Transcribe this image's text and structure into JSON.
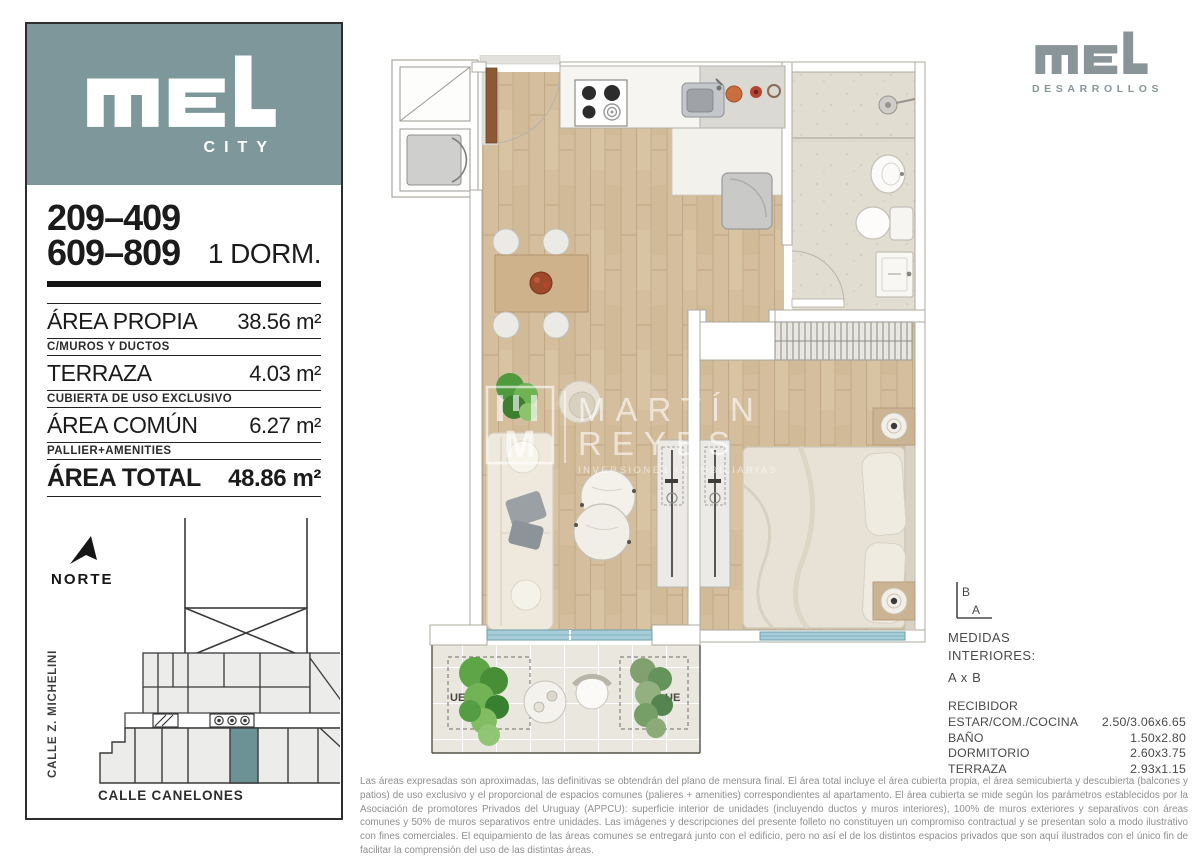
{
  "brand": {
    "city_label": "CITY",
    "desarrollos_label": "DESARROLLOS",
    "teal_color": "#7d979b",
    "logo_gray_color": "#8a9599"
  },
  "sidebar": {
    "unit_range_1": "209–409",
    "unit_range_2": "609–809",
    "unit_type": "1 DORM.",
    "rows": [
      {
        "label": "ÁREA PROPIA",
        "value": "38.56 m²"
      },
      {
        "label": "TERRAZA",
        "value": "4.03 m²"
      },
      {
        "label": "ÁREA COMÚN",
        "value": "6.27 m²"
      },
      {
        "label": "ÁREA TOTAL",
        "value": "48.86 m²"
      }
    ],
    "notes": [
      "C/MUROS Y DUCTOS",
      "CUBIERTA DE USO EXCLUSIVO",
      "PALLIER+AMENITIES"
    ],
    "north_label": "NORTE",
    "map": {
      "street_left": "CALLE Z. MICHELINI",
      "street_bottom": "CALLE CANELONES",
      "unit_highlight_color": "#6d9296"
    }
  },
  "plan": {
    "watermark": {
      "initial": "M",
      "name_line1": "MARTÍN",
      "name_line2": "REYES",
      "tagline": "INVERSIONES INMOBILIARIAS"
    },
    "exterior_unit_label": "UE"
  },
  "measures": {
    "axis": {
      "vertical": "B",
      "horizontal": "A"
    },
    "heading1": "MEDIDAS",
    "heading2": "INTERIORES:",
    "heading3": "A x B",
    "rows": [
      {
        "label": "RECIBIDOR",
        "value": ""
      },
      {
        "label": "ESTAR/COM./COCINA",
        "value": "2.50/3.06x6.65"
      },
      {
        "label": "BAÑO",
        "value": "1.50x2.80"
      },
      {
        "label": "DORMITORIO",
        "value": "2.60x3.75"
      },
      {
        "label": "TERRAZA",
        "value": "2.93x1.15"
      }
    ]
  },
  "disclaimer": "Las áreas expresadas son aproximadas, las definitivas se obtendrán del plano de mensura final. El área total incluye el área cubierta propia, el área semicubierta y descubierta (balcones y patios) de uso exclusivo y el proporcional de espacios comunes (palieres + amenities) correspondientes al apartamento. El área cubierta se mide según los parámetros establecidos por la Asociación de promotores Privados del Uruguay (APPCU): superficie interior de unidades (incluyendo ductos y muros interiores), 100% de muros exteriores y separativos con áreas comunes y 50% de muros separativos entre unidades. Las imágenes y descripciones del presente folleto no constituyen un compromiso contractual y se presentan solo a modo ilustrativo con fines comerciales. El equipamiento de las áreas comunes se entregará junto con el edificio, pero no así el de los distintos espacios privados que son aquí ilustrados con el único fin de facilitar la comprensión del uso de las distintas áreas."
}
